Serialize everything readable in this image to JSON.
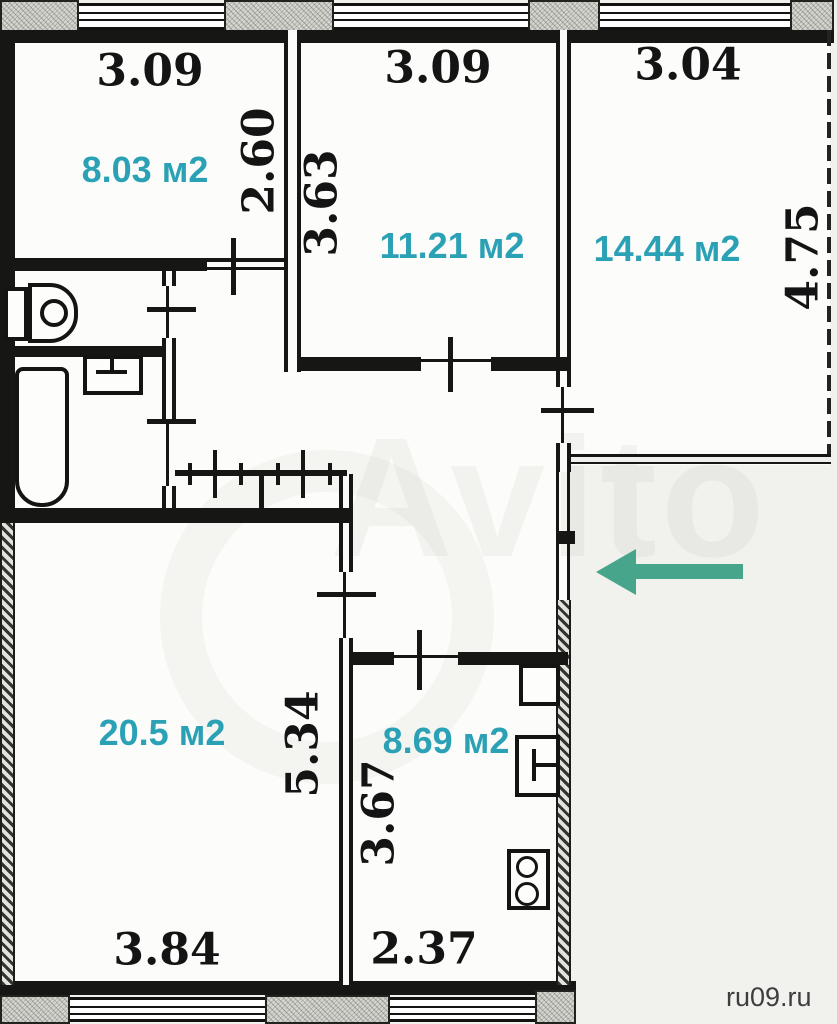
{
  "plan_labels": {
    "room1_area": "8.03 м2",
    "room2_area": "11.21 м2",
    "room3_area": "14.44 м2",
    "living_area": "20.5 м2",
    "kitchen_area": "8.69 м2",
    "room1_width": "3.09",
    "room1_depth": "2.60",
    "room2_width": "3.09",
    "room2_depth": "3.63",
    "room3_width": "3.04",
    "room3_depth": "4.75",
    "living_width": "3.84",
    "living_depth": "5.34",
    "kitchen_width": "2.37",
    "kitchen_depth": "3.67"
  },
  "watermarks": {
    "brand": "Avito",
    "site": "ru09.ru"
  },
  "colors": {
    "area_text": "#2ba1b5",
    "dimension_text": "#141414",
    "arrow": "#46a58a",
    "wall": "#161614"
  }
}
